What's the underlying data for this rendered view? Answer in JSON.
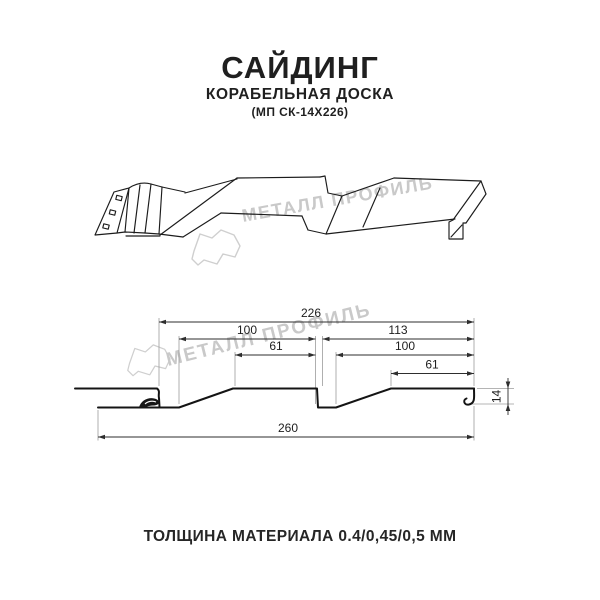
{
  "header": {
    "title": "САЙДИНГ",
    "subtitle": "КОРАБЕЛЬНАЯ ДОСКА",
    "model": "(МП СК-14Х226)"
  },
  "footer": {
    "thickness": "ТОЛЩИНА МАТЕРИАЛА 0.4/0,45/0,5 ММ"
  },
  "watermark": {
    "text": "МЕТАЛЛ ПРОФИЛЬ",
    "color": "#c9c9c9"
  },
  "diagram": {
    "dims": {
      "overall": "226",
      "left_board": "100",
      "right_board": "113",
      "left_top": "61",
      "right_mid": "100",
      "right_top": "61",
      "total": "260",
      "height": "14"
    }
  },
  "colors": {
    "line": "#1c1c1c",
    "dimension": "#2e2e2e",
    "extension": "#9b9b9b",
    "watermark": "#c9c9c9"
  }
}
